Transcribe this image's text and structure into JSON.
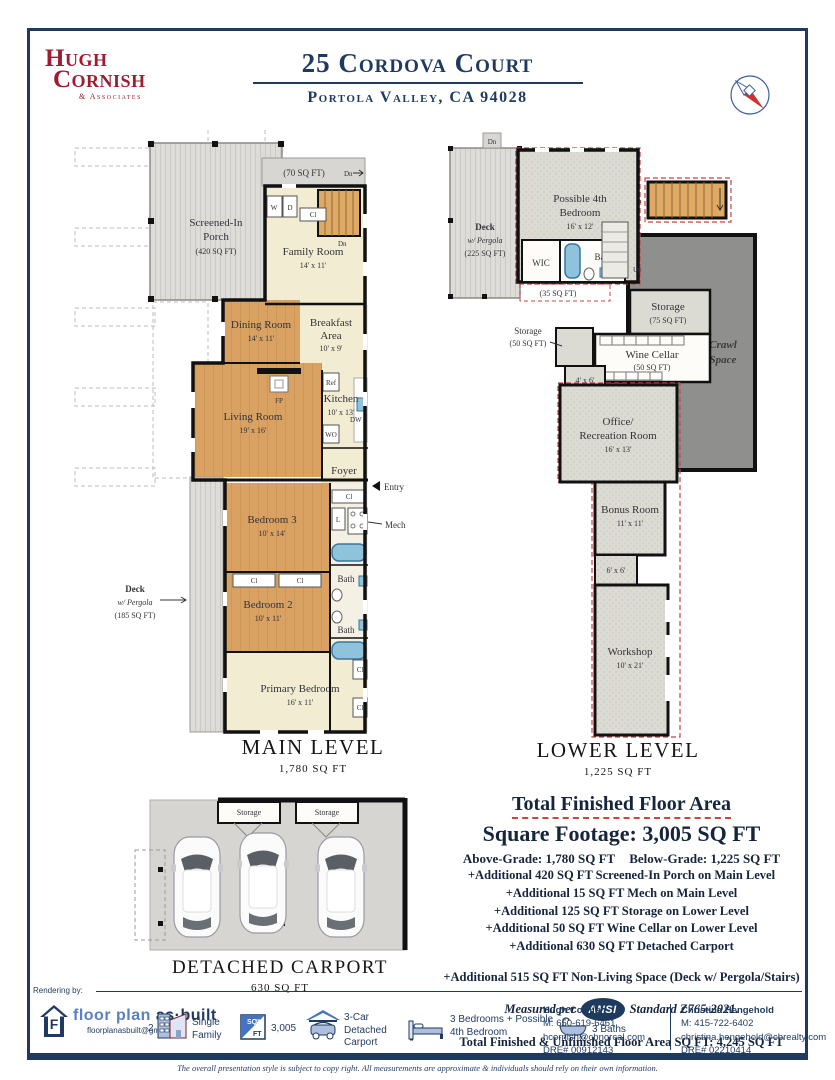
{
  "header": {
    "brand_l1": "Hugh",
    "brand_l2": "Cornish",
    "brand_l3": "& Associates",
    "title": "25 Cordova Court",
    "subtitle": "Portola Valley, CA 94028"
  },
  "main_level": {
    "porch_l1": "Screened-In",
    "porch_l2": "Porch",
    "porch_l3": "(420 SQ FT)",
    "sq70": "(70 SQ FT)",
    "dn": "Dn",
    "w": "W",
    "d": "D",
    "cl": "Cl",
    "linen": "L",
    "family_l1": "Family Room",
    "family_l2": "14' x 11'",
    "dining_l1": "Dining Room",
    "dining_l2": "14' x 11'",
    "breakfast_l1": "Breakfast",
    "breakfast_l2": "Area",
    "breakfast_l3": "10' x 9'",
    "living_l1": "Living Room",
    "living_l2": "19' x 16'",
    "kitchen_l1": "Kitchen",
    "kitchen_l2": "10' x 13'",
    "ref": "Ref",
    "wo": "WO",
    "dw": "DW",
    "fp": "FP",
    "foyer": "Foyer",
    "entry": "Entry",
    "mech": "Mech",
    "bath": "Bath",
    "bed3_l1": "Bedroom 3",
    "bed3_l2": "10' x 14'",
    "bed2_l1": "Bedroom 2",
    "bed2_l2": "10' x 11'",
    "primary_l1": "Primary Bedroom",
    "primary_l2": "16' x 11'",
    "deck_l1": "Deck",
    "deck_l2": "w/ Pergola",
    "deck_l3": "(185 SQ FT)",
    "caption": "MAIN LEVEL",
    "sqft": "1,780 SQ FT"
  },
  "lower_level": {
    "deck_l1": "Deck",
    "deck_l2": "w/ Pergola",
    "deck_l3": "(225 SQ FT)",
    "dn": "Dn",
    "up": "Up",
    "bed4_l1": "Possible 4th",
    "bed4_l2": "Bedroom",
    "bed4_l3": "16' x 12'",
    "wic": "WIC",
    "bath": "Bath",
    "sq35": "(35 SQ FT)",
    "storage": "Storage",
    "storage50": "(50 SQ FT)",
    "storage75": "(75 SQ FT)",
    "wine_l1": "Wine Cellar",
    "wine_l2": "(50 SQ FT)",
    "crawl_l1": "Crawl",
    "crawl_l2": "Space",
    "r46": "4' x 6'",
    "r66": "6' x 6'",
    "office_l1": "Office/",
    "office_l2": "Recreation Room",
    "office_l3": "16' x 13'",
    "bonus_l1": "Bonus Room",
    "bonus_l2": "11' x 11'",
    "workshop_l1": "Workshop",
    "workshop_l2": "10' x 21'",
    "caption": "LOWER LEVEL",
    "sqft": "1,225 SQ FT"
  },
  "carport": {
    "storage": "Storage",
    "caption": "DETACHED CARPORT",
    "sqft": "630 SQ FT"
  },
  "summary": {
    "title": "Total Finished Floor Area",
    "square_footage": "Square Footage: 3,005 SQ FT",
    "above": "Above-Grade: 1,780 SQ FT",
    "below": "Below-Grade: 1,225 SQ FT",
    "additional": [
      "+Additional 420 SQ FT Screened-In Porch on Main Level",
      "+Additional 15 SQ FT Mech on Main Level",
      "+Additional 125 SQ FT Storage on Lower Level",
      "+Additional 50 SQ FT Wine Cellar on Lower Level",
      "+Additional 630 SQ FT Detached Carport"
    ],
    "nonliving": "+Additional 515 SQ FT Non-Living Space (Deck w/ Pergola/Stairs)",
    "measured_pre": "Measured per",
    "ansi": "ANSI",
    "measured_post": "Standard Z765-2021.",
    "total": "Total Finished & Unfinished Floor Area SQ FT: 4,245 SQ FT"
  },
  "footer": {
    "rendering_by": "Rendering by:",
    "brand_f": "F",
    "brand_name_1": "floor plan",
    "brand_name_2": "as·built",
    "brand_email": "floorplanasbuilt@gmail.com",
    "stories": "2",
    "fact_family": "Single Family",
    "sq": "SQ",
    "ft": "FT",
    "sqft_value": "3,005",
    "fact_carport": "3-Car Detached Carport",
    "fact_bedrooms": "3 Bedrooms + Possible 4th Bedroom",
    "fact_baths": "3 Baths",
    "agents": [
      {
        "name": "Hugh Cornish",
        "phone": "M: 650-619-6461",
        "email": "hcornish@cbnorcal.com",
        "dre": "DRE# 00912143"
      },
      {
        "name": "Christina Hengehold",
        "phone": "M: 415-722-6402",
        "email": "christina.hengehold@cbrealty.com",
        "dre": "DRE# 02210414"
      }
    ],
    "disclaimer": "The overall presentation style is subject to copy right. All measurements are approximate & individuals should rely on their own information."
  },
  "colors": {
    "navy": "#1e3a5f",
    "crimson": "#9e1b32",
    "dashed_red": "#cc4444",
    "wood": "#d9a263",
    "cream": "#f1ecd2",
    "porch_gray": "#d7d6d2",
    "stipple_gray": "#dcdbd3",
    "crawl_gray": "#8f8f8d",
    "tub_blue": "#8fc3dc",
    "footer_blue": "#5b7fc4"
  }
}
